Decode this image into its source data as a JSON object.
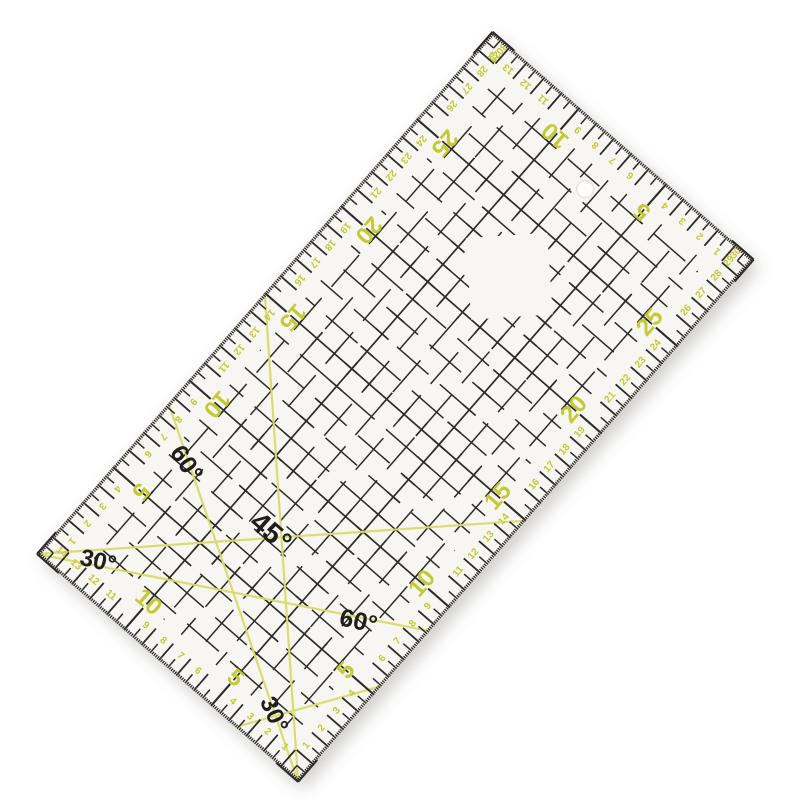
{
  "scene": {
    "background_color": "#ffffff",
    "object": "transparent quilting patchwork ruler, rotated product photo"
  },
  "ruler": {
    "placement": {
      "x": 37,
      "y": 554,
      "rotation_deg": -48.9,
      "px_per_cm": 23.1
    },
    "size_cm": {
      "length": 30,
      "width": 15
    },
    "corner_radius": 4,
    "colors": {
      "body": "#f7f6f2",
      "body_edge": "#e3e1d8",
      "ink_black": "#2c2b29",
      "ink_yellow_number": "#c2ca35",
      "ink_yellow_line": "#d8dc6a",
      "label_black": "#1e1e1c",
      "hole_fill": "#fdfdfc",
      "hole_rim": "#e0dfd8",
      "shadow": "#8a887f"
    },
    "edge_ticks": {
      "mm_len": 3.2,
      "half_cm_len": 11.5,
      "cm_len": 22,
      "five_cm_len": 29,
      "mm_w": 1.3,
      "half_w": 1.5,
      "cm_w": 1.8,
      "five_w": 2.1
    },
    "scale_numbers": {
      "big_multiple": 5,
      "big_size": 24,
      "small_size": 10,
      "small_depth_cm": 0.75,
      "big_depth_cm": 1.6,
      "small_shift_cm": 0.42
    },
    "edges": [
      {
        "id": "top-long",
        "rotate_deg": 180,
        "max": 30,
        "numbers": [
          1,
          2,
          3,
          4,
          5,
          6,
          7,
          8,
          9,
          10,
          11,
          12,
          13,
          14,
          15,
          16,
          17,
          18,
          19,
          20,
          21,
          22,
          23,
          24,
          25,
          26,
          27,
          28,
          29,
          30
        ]
      },
      {
        "id": "bottom-long",
        "rotate_deg": 0,
        "max": 30,
        "numbers": [
          1,
          2,
          3,
          4,
          5,
          6,
          7,
          8,
          9,
          10,
          11,
          12,
          13,
          14,
          15,
          16,
          17,
          18,
          19,
          20,
          21,
          22,
          23,
          24,
          25,
          26,
          27,
          28,
          29,
          30
        ]
      },
      {
        "id": "left-short",
        "rotate_deg": 90,
        "max": 15,
        "numbers": [
          1,
          2,
          3,
          4,
          5,
          6,
          7,
          8,
          9,
          10,
          11,
          12,
          13,
          14
        ]
      },
      {
        "id": "right-short",
        "rotate_deg": 270,
        "max": 15,
        "numbers": [
          1,
          2,
          3,
          4,
          5,
          6,
          7,
          8,
          9,
          10,
          11,
          12,
          13,
          14
        ]
      }
    ],
    "grid": {
      "inset_px": 34,
      "line_w": 1.5,
      "dash": "42 15",
      "plain_v_cm": [
        2,
        3,
        4,
        6,
        7,
        8,
        9,
        11,
        12,
        13
      ],
      "plain_u_cm": [
        2,
        3,
        4,
        6,
        7,
        8,
        9,
        11,
        12,
        13,
        14,
        16,
        17,
        18,
        19,
        21,
        22,
        23,
        24,
        26,
        27,
        28
      ],
      "major_v_cm": [
        5,
        10
      ],
      "major_u_cm": [
        5,
        10,
        15,
        20,
        25
      ],
      "cross_tick_half": 8.5,
      "cross_tick_u_range": [
        2,
        28
      ],
      "cross_tick_v_range": [
        2,
        13
      ]
    },
    "angle_lines": [
      {
        "name": "line-45deg-from-left-corner",
        "from_cm": [
          0,
          0
        ],
        "to_cm": [
          15,
          15
        ]
      },
      {
        "name": "line-45deg-to-bottom-corner",
        "from_cm": [
          15,
          0
        ],
        "to_cm": [
          0,
          15
        ]
      },
      {
        "name": "line-30deg-from-left-corner",
        "from_cm": [
          0,
          0
        ],
        "to_cm": [
          8.66,
          15
        ]
      },
      {
        "name": "line-60deg-to-bottom-corner",
        "from_cm": [
          8.66,
          0
        ],
        "to_cm": [
          0,
          15
        ]
      },
      {
        "name": "line-30deg-bottom",
        "from_cm": [
          0,
          11.4
        ],
        "to_cm": [
          5.5,
          15
        ]
      }
    ],
    "angle_labels": [
      {
        "text": "60°",
        "u_cm": 7.2,
        "v_cm": 2.3,
        "rotate_deg": 105,
        "size": 25
      },
      {
        "text": "45°",
        "u_cm": 7.35,
        "v_cm": 7.0,
        "rotate_deg": 90,
        "size": 29
      },
      {
        "text": "30°",
        "u_cm": 1.5,
        "v_cm": 2.2,
        "rotate_deg": 62,
        "size": 24
      },
      {
        "text": "60°",
        "u_cm": 6.95,
        "v_cm": 12.4,
        "rotate_deg": 62,
        "size": 25
      },
      {
        "text": "30°",
        "u_cm": 1.5,
        "v_cm": 12.3,
        "rotate_deg": 115,
        "size": 24
      }
    ],
    "diamond_window": {
      "center_cm": [
        22.5,
        7.5
      ],
      "half_diag_cm": 2.5
    },
    "hanging_hole": {
      "center_cm": [
        27.5,
        7.5
      ],
      "radius_px": 8.5
    }
  }
}
